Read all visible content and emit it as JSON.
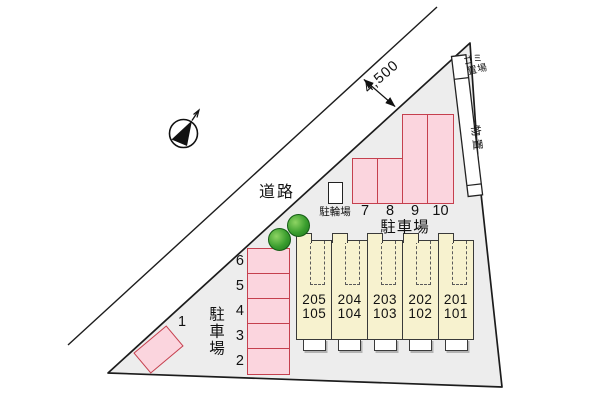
{
  "site": {
    "road_label": "道路",
    "road_width_label": "4,500",
    "garbage_label_line1": "ゴミ",
    "garbage_label_line2": "置場",
    "storage_label": "物置"
  },
  "bicycle_parking": {
    "label": "駐輪場"
  },
  "parking_north": {
    "label": "駐車場",
    "spaces": [
      "7",
      "8",
      "9",
      "10"
    ]
  },
  "parking_west": {
    "label": "駐車場",
    "spaces": [
      "6",
      "5",
      "4",
      "3",
      "2"
    ],
    "diagonal_space": "1"
  },
  "building": {
    "units": [
      {
        "upper": "205",
        "lower": "105"
      },
      {
        "upper": "204",
        "lower": "104"
      },
      {
        "upper": "203",
        "lower": "103"
      },
      {
        "upper": "202",
        "lower": "102"
      },
      {
        "upper": "201",
        "lower": "101"
      }
    ]
  },
  "colors": {
    "parking_fill": "#fbd5de",
    "parking_border": "#c5404e",
    "building_fill": "#f7f2cf",
    "building_border": "#3a3a3a",
    "site_fill": "#ededed",
    "line_color": "#1c1c1c",
    "tree_green": "#3a9e2e"
  }
}
